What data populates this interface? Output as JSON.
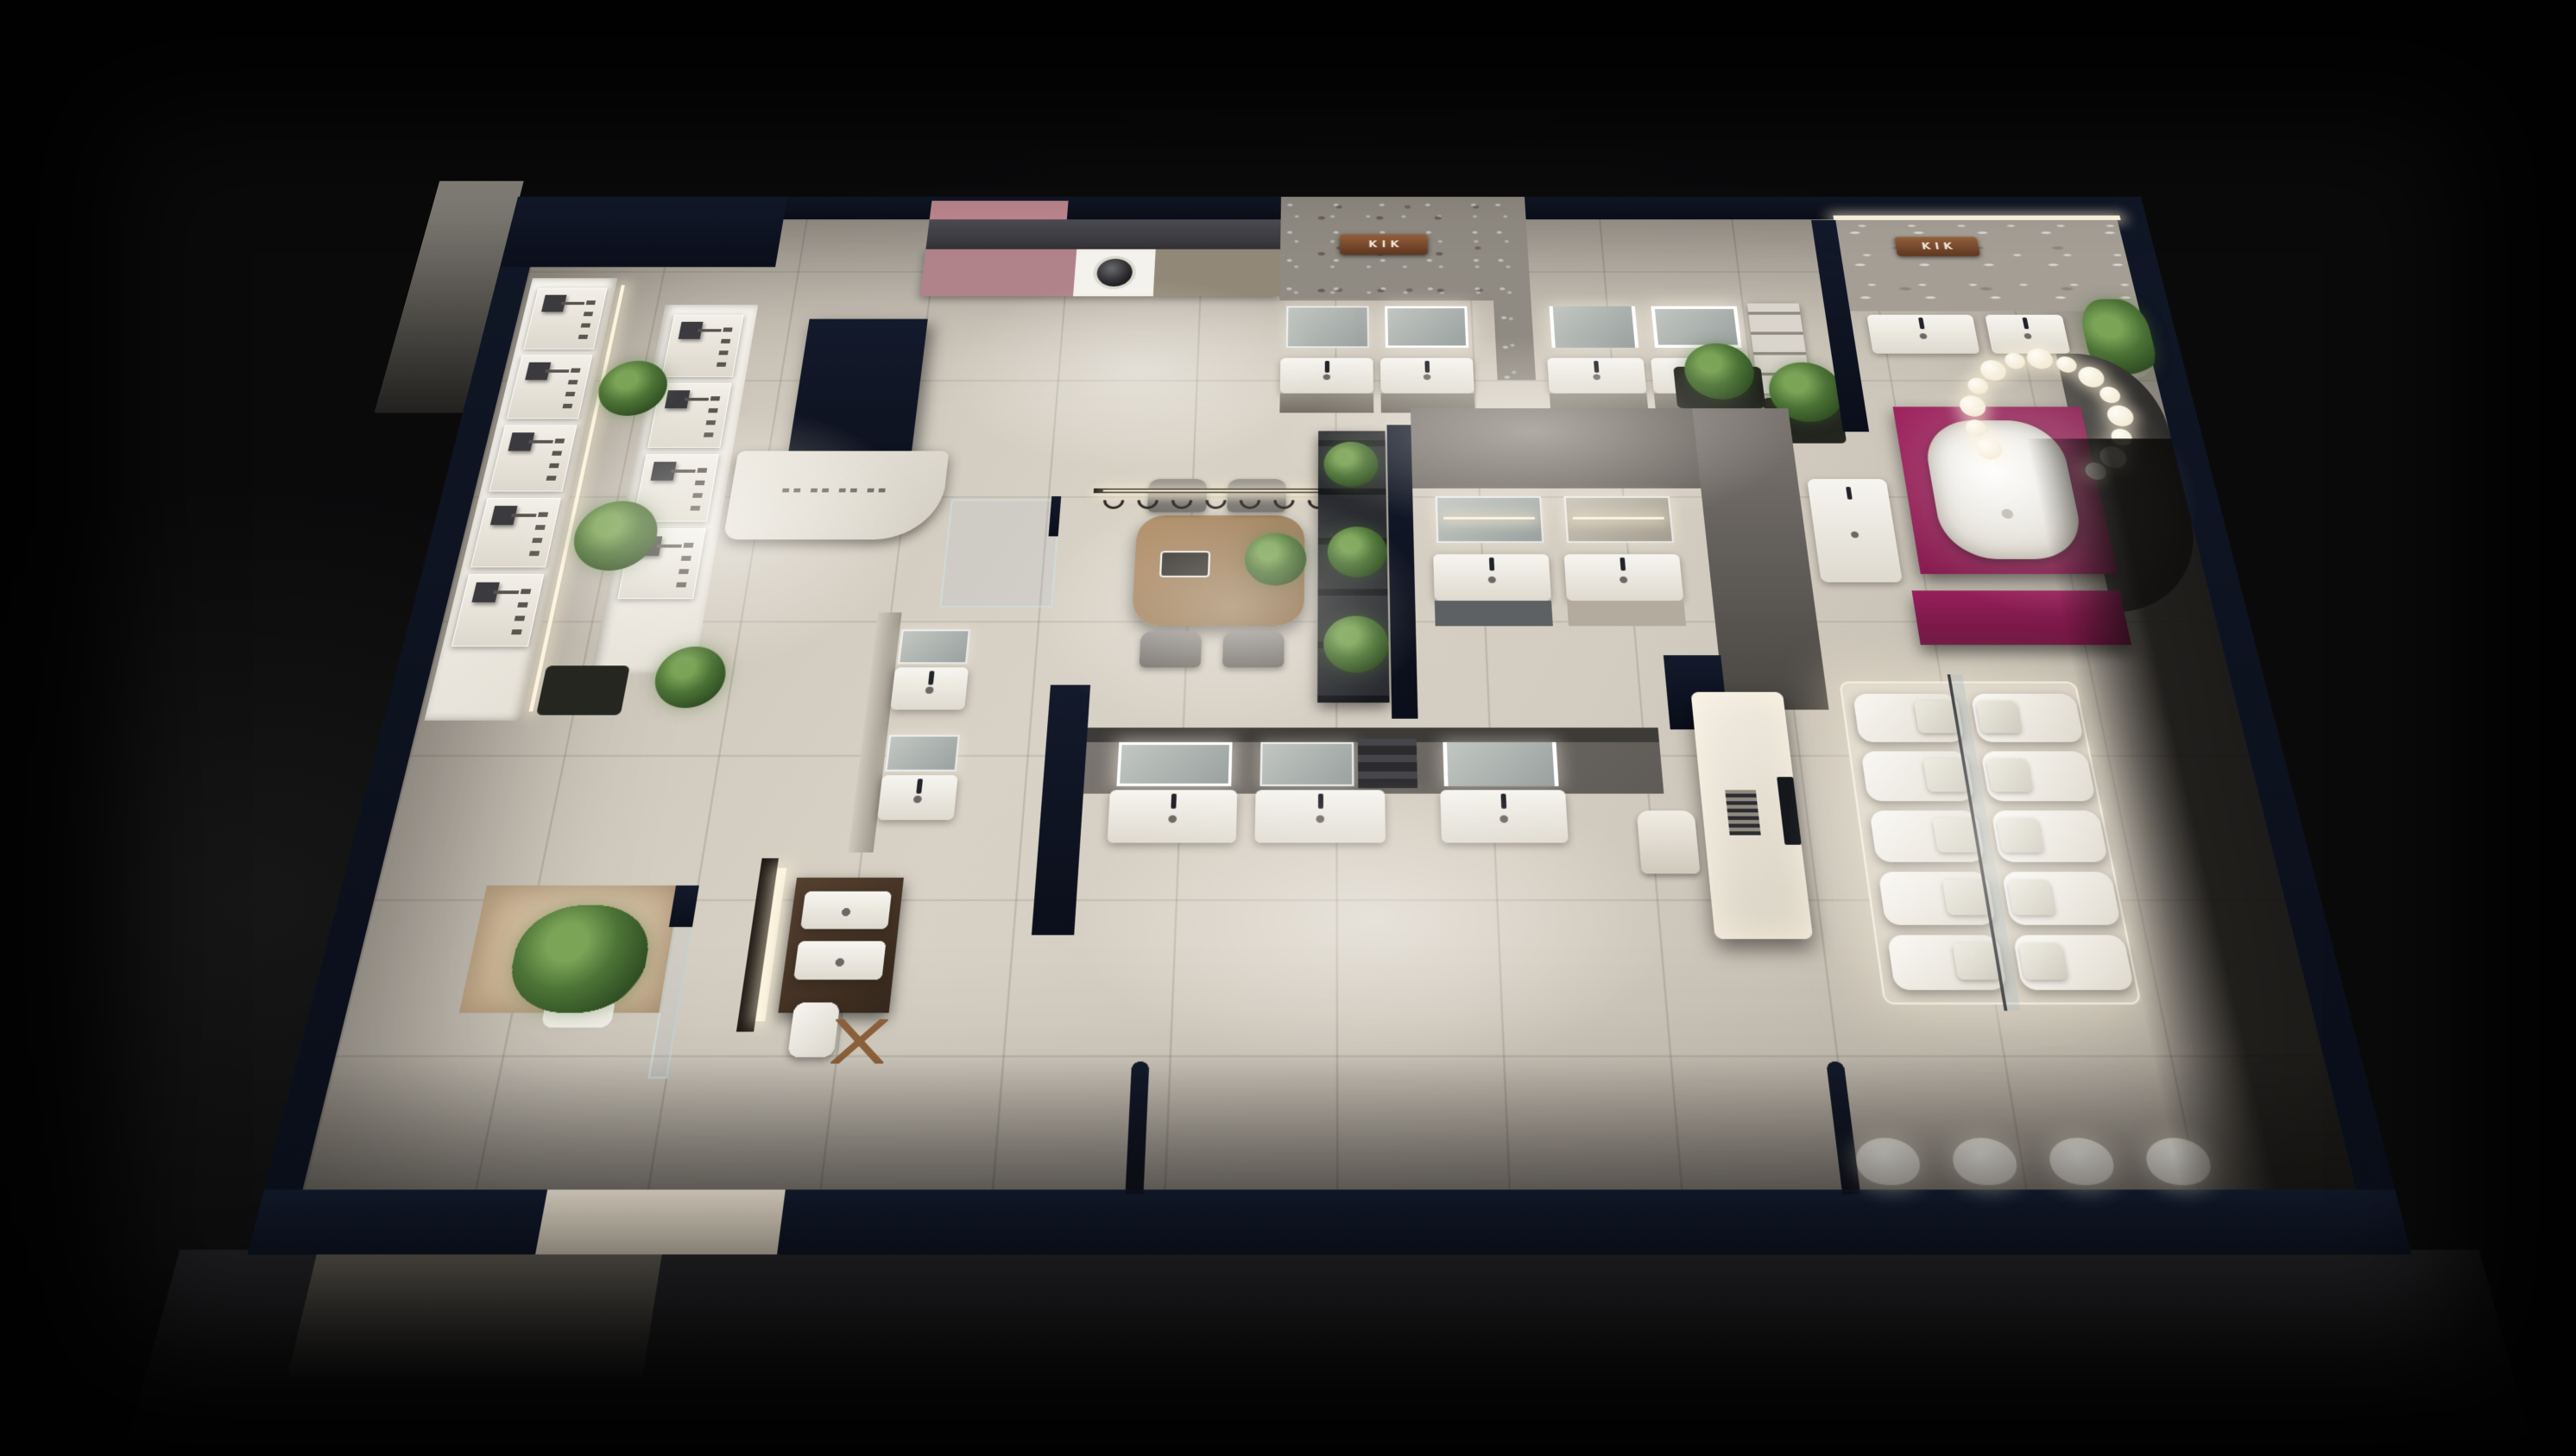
{
  "scene": {
    "title": "KIK sanitary-ware showroom — overhead 3D floor-plan render",
    "environment": "dark exhibition hall, warm accent lighting, greige tiled floor, navy perimeter walls",
    "signs": [
      {
        "id": "sign-top-center",
        "location": "stone feature wall, top-center",
        "text": "KIK"
      },
      {
        "id": "sign-top-right",
        "location": "marble feature wall, top-right",
        "text": "KIK"
      }
    ],
    "palette": {
      "background": "#0a0a0b",
      "floor": "#d3ccc0",
      "perimeter_wall_navy": "#0d1220",
      "stone_wall": "#8f8a82",
      "marble_wall": "#a49e95",
      "copper_sign": "#7c4a30",
      "magenta_accent": "#8e1d52",
      "mauve_cabinet": "#b08289",
      "wood": "#a5825f",
      "fixture_white": "#f6f4ee",
      "plant_green": "#4d7437",
      "warm_light": "#fdf4df"
    },
    "zones": [
      {
        "name": "shower-fixture-display-walls",
        "items": "two lit display walls with rain shower heads, hand showers and taps, potted palms"
      },
      {
        "name": "laundry-display",
        "items": "built-in washing machine, mauve cabinet fronts, dark counter, pink wall panel"
      },
      {
        "name": "reception-counter",
        "items": "white curved counter with small brand lettering (illegible at this scale)"
      },
      {
        "name": "top-vanity-row",
        "items": "four wall-hung vanities with LED mirrors and shelving under stone wall"
      },
      {
        "name": "consultation-area",
        "items": "oval wood table, four grey chairs, linear pendant with seven hooks, tray and plant"
      },
      {
        "name": "plant-shelf-partition",
        "items": "black metal shelving with plants beside navy partition"
      },
      {
        "name": "center-vanity-islands",
        "items": "two mirror-cabinet vanity displays against grey wall, white vanity beyond"
      },
      {
        "name": "lower-vanity-row",
        "items": "three vanity bays with lit mirrors facing the main aisle"
      },
      {
        "name": "left-vanity-pair",
        "items": "two compact vanities on a partition"
      },
      {
        "name": "walk-in-shower",
        "items": "glass shower enclosure"
      },
      {
        "name": "dark-wood-vanity",
        "items": "dark timber double vanity, wooden stool, white towel, warm LED blade"
      },
      {
        "name": "bathtub-display",
        "items": "freestanding white tub on magenta plinth, bubble-ring chandelier, curved dark partition"
      },
      {
        "name": "magenta-desk",
        "items": "magenta consult desk"
      },
      {
        "name": "toilet-display",
        "items": "ten one-piece toilets in two rows on an underlit platform with glass divider"
      },
      {
        "name": "smart-toilet-island",
        "items": "white island with control screen, keypad and seat"
      },
      {
        "name": "urinal-row",
        "items": "four wall-hung urinals on bottom wall"
      },
      {
        "name": "entrance",
        "items": "indoor tree in white pot, beige feature wall, glass door"
      }
    ],
    "counts": {
      "shower_columns_wall_a": 5,
      "shower_columns_wall_b": 4,
      "pendant_hooks": 7,
      "chandelier_spheres": 14,
      "toilet_rows": 5,
      "toilet_cols": 2,
      "urinals": 4,
      "chairs": 4
    }
  }
}
